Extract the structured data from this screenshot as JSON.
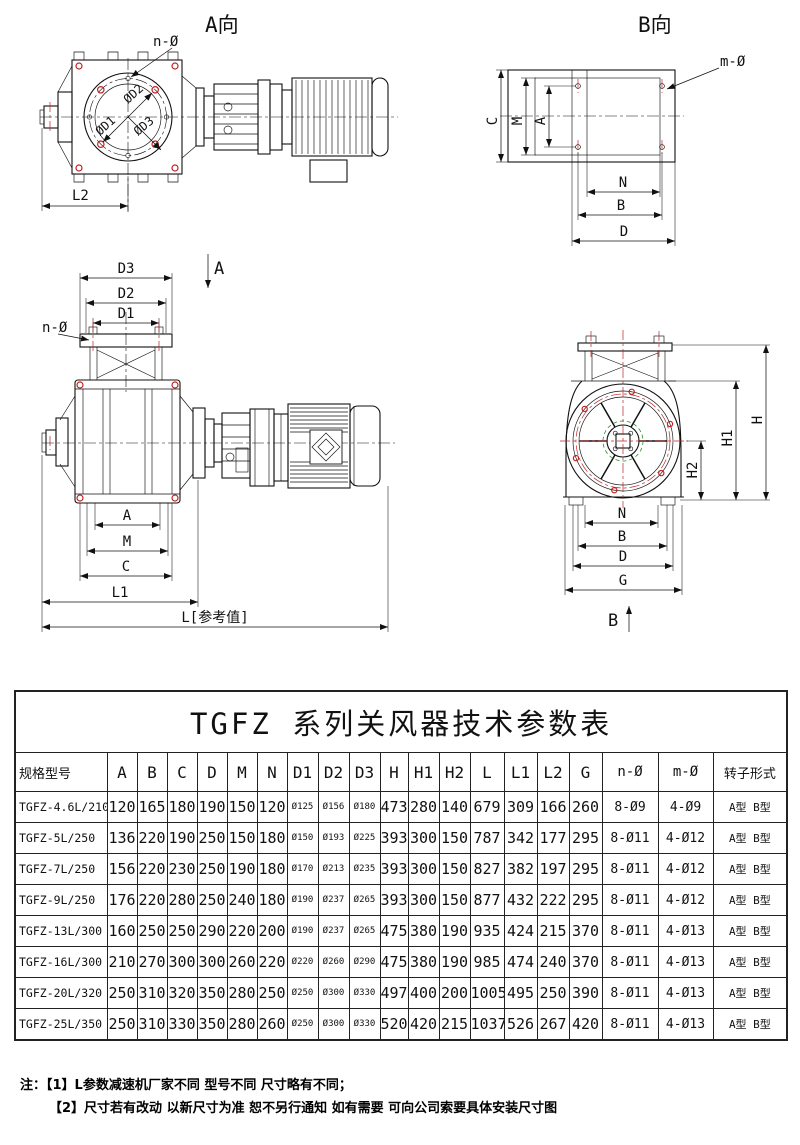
{
  "drawing": {
    "view_a_title": "A向",
    "view_b_title": "B向",
    "labels": {
      "n_hole": "n-Ø",
      "m_hole": "m-Ø",
      "phi_d1": "ØD1",
      "phi_d2": "ØD2",
      "phi_d3": "ØD3",
      "d1": "D1",
      "d2": "D2",
      "d3": "D3",
      "a": "A",
      "b": "B",
      "c": "C",
      "d": "D",
      "m": "M",
      "n": "N",
      "g": "G",
      "h": "H",
      "h1": "H1",
      "h2": "H2",
      "l1": "L1",
      "l2": "L2",
      "l_ref": "L[参考值]",
      "section_a": "A",
      "section_b": "B"
    }
  },
  "table": {
    "title": "TGFZ 系列关风器技术参数表",
    "headers": [
      "规格型号",
      "A",
      "B",
      "C",
      "D",
      "M",
      "N",
      "D1",
      "D2",
      "D3",
      "H",
      "H1",
      "H2",
      "L",
      "L1",
      "L2",
      "G",
      "n-Ø",
      "m-Ø",
      "转子形式"
    ],
    "rows": [
      [
        "TGFZ-4.6L/210",
        "120",
        "165",
        "180",
        "190",
        "150",
        "120",
        "Ø125",
        "Ø156",
        "Ø180",
        "473",
        "280",
        "140",
        "679",
        "309",
        "166",
        "260",
        "8-Ø9",
        "4-Ø9",
        "A型 B型"
      ],
      [
        "TGFZ-5L/250",
        "136",
        "220",
        "190",
        "250",
        "150",
        "180",
        "Ø150",
        "Ø193",
        "Ø225",
        "393",
        "300",
        "150",
        "787",
        "342",
        "177",
        "295",
        "8-Ø11",
        "4-Ø12",
        "A型 B型"
      ],
      [
        "TGFZ-7L/250",
        "156",
        "220",
        "230",
        "250",
        "190",
        "180",
        "Ø170",
        "Ø213",
        "Ø235",
        "393",
        "300",
        "150",
        "827",
        "382",
        "197",
        "295",
        "8-Ø11",
        "4-Ø12",
        "A型 B型"
      ],
      [
        "TGFZ-9L/250",
        "176",
        "220",
        "280",
        "250",
        "240",
        "180",
        "Ø190",
        "Ø237",
        "Ø265",
        "393",
        "300",
        "150",
        "877",
        "432",
        "222",
        "295",
        "8-Ø11",
        "4-Ø12",
        "A型 B型"
      ],
      [
        "TGFZ-13L/300",
        "160",
        "250",
        "250",
        "290",
        "220",
        "200",
        "Ø190",
        "Ø237",
        "Ø265",
        "475",
        "380",
        "190",
        "935",
        "424",
        "215",
        "370",
        "8-Ø11",
        "4-Ø13",
        "A型 B型"
      ],
      [
        "TGFZ-16L/300",
        "210",
        "270",
        "300",
        "300",
        "260",
        "220",
        "Ø220",
        "Ø260",
        "Ø290",
        "475",
        "380",
        "190",
        "985",
        "474",
        "240",
        "370",
        "8-Ø11",
        "4-Ø13",
        "A型 B型"
      ],
      [
        "TGFZ-20L/320",
        "250",
        "310",
        "320",
        "350",
        "280",
        "250",
        "Ø250",
        "Ø300",
        "Ø330",
        "497",
        "400",
        "200",
        "1005",
        "495",
        "250",
        "390",
        "8-Ø11",
        "4-Ø13",
        "A型 B型"
      ],
      [
        "TGFZ-25L/350",
        "250",
        "310",
        "330",
        "350",
        "280",
        "260",
        "Ø250",
        "Ø300",
        "Ø330",
        "520",
        "420",
        "215",
        "1037",
        "526",
        "267",
        "420",
        "8-Ø11",
        "4-Ø13",
        "A型 B型"
      ]
    ]
  },
  "notes": {
    "label": "注：",
    "items": [
      "【1】L参数减速机厂家不同 型号不同 尺寸略有不同；",
      "【2】尺寸若有改动 以新尺寸为准 恕不另行通知 如有需要 可向公司索要具体安装尺寸图"
    ]
  }
}
